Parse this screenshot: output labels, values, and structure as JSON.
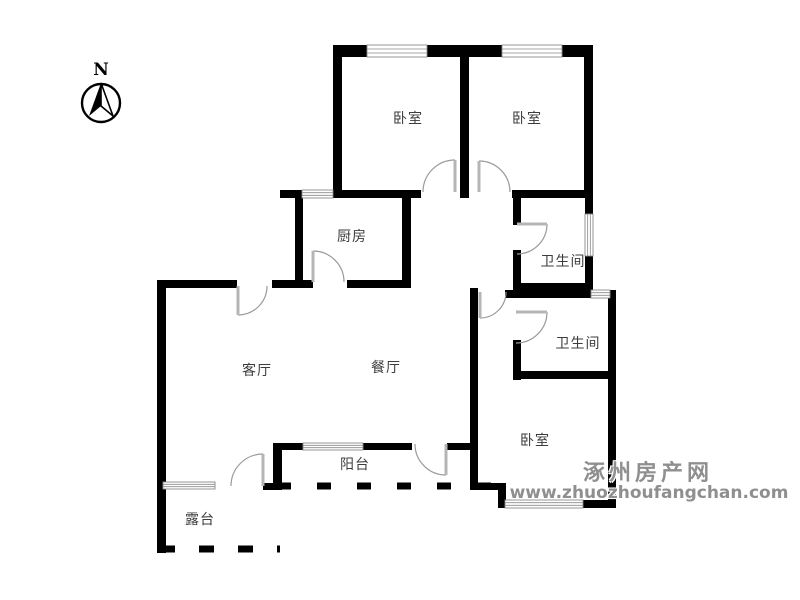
{
  "compass": {
    "label": "N"
  },
  "rooms": [
    {
      "id": "bedroom-1",
      "label": "卧室",
      "x": 408,
      "y": 118
    },
    {
      "id": "bedroom-2",
      "label": "卧室",
      "x": 527,
      "y": 118
    },
    {
      "id": "kitchen",
      "label": "厨房",
      "x": 352,
      "y": 236
    },
    {
      "id": "bathroom-1",
      "label": "卫生间",
      "x": 563,
      "y": 261
    },
    {
      "id": "bathroom-2",
      "label": "卫生间",
      "x": 578,
      "y": 343
    },
    {
      "id": "living-room",
      "label": "客厅",
      "x": 257,
      "y": 370
    },
    {
      "id": "dining-room",
      "label": "餐厅",
      "x": 386,
      "y": 367
    },
    {
      "id": "balcony",
      "label": "阳台",
      "x": 355,
      "y": 464
    },
    {
      "id": "terrace",
      "label": "露台",
      "x": 200,
      "y": 519
    },
    {
      "id": "bedroom-3",
      "label": "卧室",
      "x": 535,
      "y": 440
    }
  ],
  "watermark": {
    "title": "涿州房产网",
    "url": "www.zhuozhoufangchan.com",
    "color": "#8f8f8f"
  },
  "floorplan": {
    "wall_color": "#000000",
    "window_color": "#8a8a8a",
    "door_arc_color": "#9a9a9a",
    "door_leaf_color": "#b5b5b5",
    "walls": [
      [
        333,
        45,
        9,
        153
      ],
      [
        460,
        45,
        9,
        153
      ],
      [
        584,
        45,
        9,
        153
      ],
      [
        333,
        45,
        136,
        12
      ],
      [
        462,
        45,
        131,
        12
      ],
      [
        280,
        190,
        141,
        8
      ],
      [
        512,
        190,
        81,
        8
      ],
      [
        295,
        190,
        8,
        98
      ],
      [
        402,
        190,
        9,
        98
      ],
      [
        157,
        280,
        9,
        273
      ],
      [
        157,
        280,
        80,
        8
      ],
      [
        272,
        280,
        41,
        8
      ],
      [
        347,
        280,
        63,
        8
      ],
      [
        513,
        198,
        8,
        27
      ],
      [
        513,
        250,
        8,
        41
      ],
      [
        585,
        198,
        8,
        17
      ],
      [
        585,
        255,
        8,
        36
      ],
      [
        513,
        283,
        80,
        8
      ],
      [
        505,
        290,
        111,
        8
      ],
      [
        608,
        290,
        8,
        218
      ],
      [
        513,
        340,
        8,
        40
      ],
      [
        513,
        371,
        103,
        8
      ],
      [
        470,
        288,
        8,
        202
      ],
      [
        273,
        443,
        139,
        7
      ],
      [
        447,
        443,
        23,
        7
      ],
      [
        273,
        443,
        9,
        47
      ],
      [
        263,
        483,
        19,
        7
      ],
      [
        470,
        483,
        35,
        7
      ],
      [
        498,
        483,
        8,
        25
      ],
      [
        498,
        500,
        118,
        8
      ]
    ],
    "windows": [
      [
        367,
        45,
        60,
        12
      ],
      [
        502,
        45,
        60,
        12
      ],
      [
        302,
        190,
        31,
        8
      ],
      [
        591,
        290,
        19,
        8
      ],
      [
        585,
        214,
        8,
        42
      ],
      [
        303,
        443,
        60,
        7
      ],
      [
        505,
        500,
        78,
        8
      ],
      [
        163,
        482,
        52,
        7
      ]
    ],
    "doors": [
      [
        455,
        192,
        32,
        270,
        180
      ],
      [
        479,
        192,
        31,
        270,
        0
      ],
      [
        313,
        282,
        31,
        270,
        0
      ],
      [
        238,
        286,
        29,
        90,
        0
      ],
      [
        517,
        224,
        30,
        0,
        90
      ],
      [
        480,
        292,
        26,
        90,
        0
      ],
      [
        516,
        312,
        31,
        0,
        90
      ],
      [
        446,
        444,
        31,
        90,
        180
      ],
      [
        263,
        486,
        32,
        270,
        180
      ]
    ],
    "open_edges": [
      [
        277,
        486,
        500,
        486,
        14,
        26,
        7
      ],
      [
        160,
        549,
        280,
        549,
        15,
        24,
        7
      ]
    ]
  }
}
